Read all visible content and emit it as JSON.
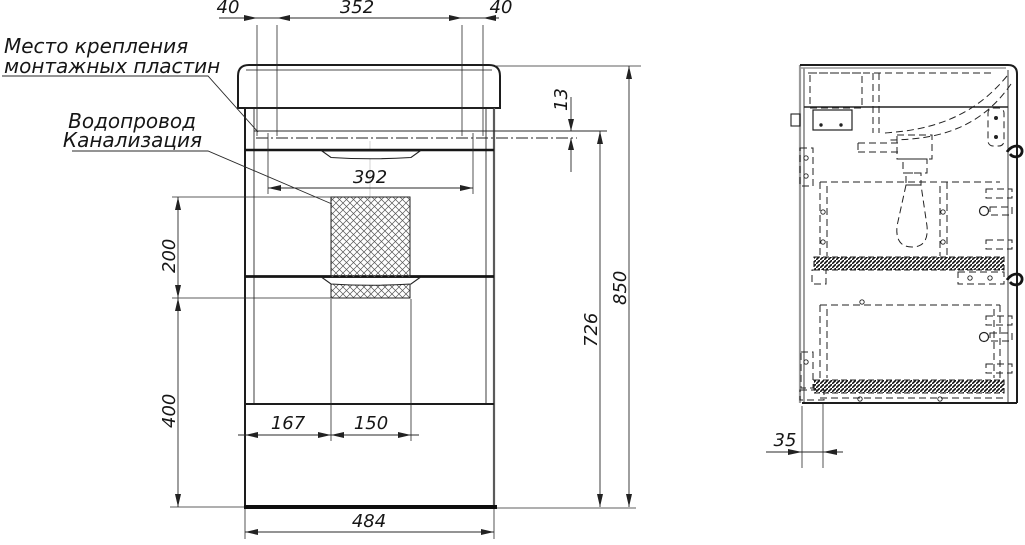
{
  "drawing": {
    "labels": {
      "mounting_line1": "Место крепления",
      "mounting_line2": "монтажных пластин",
      "plumbing_line1": "Водопровод",
      "plumbing_line2": "Канализация"
    },
    "front_dims": {
      "plate_offset_left": "40",
      "plate_spacing": "352",
      "plate_offset_right": "40",
      "plate_height": "13",
      "inner_width": "392",
      "hatch_height": "200",
      "hatch_to_floor": "400",
      "hatch_left": "167",
      "hatch_width": "150",
      "cabinet_width": "484",
      "cabinet_height": "726",
      "total_height": "850"
    },
    "side_dims": {
      "back_offset": "35"
    }
  }
}
